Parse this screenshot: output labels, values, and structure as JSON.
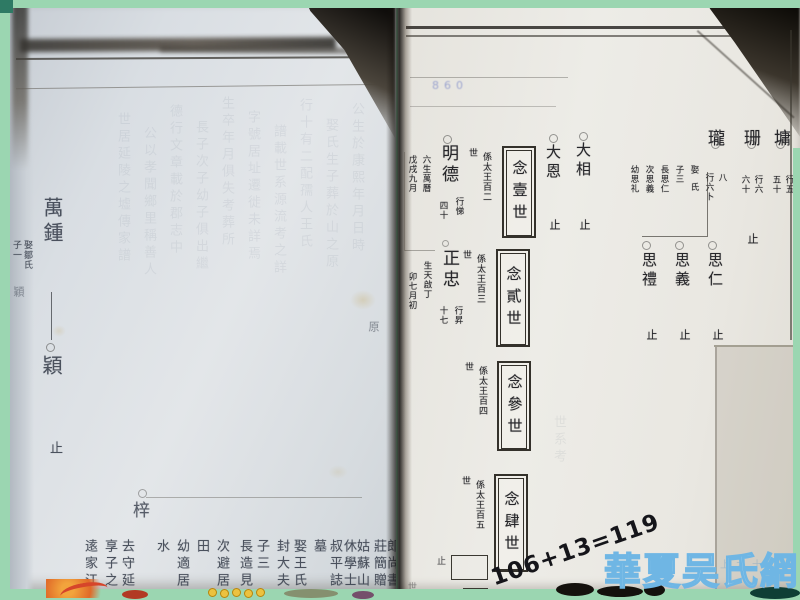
{
  "colors": {
    "mat_green": "#9bd6b1",
    "watermark_blue": "#79bfe8",
    "stamp_blue": "#6272c2",
    "ink": "#2f2d2a"
  },
  "lp": {
    "main": "萬鍾",
    "note_a": "娶鄒氏",
    "note_b": "子一",
    "note_c": "穎",
    "child": "穎",
    "stop": "止",
    "margin_char": "原",
    "zi": "梓",
    "bcols": [
      "郎尚書",
      "莊簡贈",
      "姑蘇山",
      "休學士",
      "叔平誌",
      "墓",
      "娶王氏",
      "封大夫",
      "子三",
      "長造見",
      "次避居",
      "田",
      "幼適居",
      "水"
    ],
    "blcols": [
      "去守延",
      "享子之",
      "逺家江"
    ]
  },
  "rp": {
    "stamp": "860",
    "names": [
      {
        "n": "墉",
        "a": "行五",
        "b": "五十"
      },
      {
        "n": "珊",
        "a": "行六",
        "b": "六十",
        "stop": "止"
      },
      {
        "n": "瓏",
        "a": "八",
        "b": "行六卜"
      }
    ],
    "family": [
      "娶氏",
      "子三",
      "長思仁",
      "次思義",
      "幼思礼"
    ],
    "sons": [
      {
        "n": "思仁",
        "stop": "止"
      },
      {
        "n": "思義",
        "stop": "止"
      },
      {
        "n": "思禮",
        "stop": "止"
      }
    ],
    "elders": [
      {
        "n": "大相",
        "stop": "止"
      },
      {
        "n": "大恩",
        "stop": "止"
      }
    ],
    "gens": [
      {
        "label": "念壹世",
        "note": "係太王百二",
        "cont": "世"
      },
      {
        "label": "念貳世",
        "note": "係太王百三",
        "cont": "世"
      },
      {
        "label": "念參世",
        "note": "係太王百四",
        "cont": "世"
      },
      {
        "label": "念肆世",
        "note": "係太王百五",
        "cont": "世"
      }
    ],
    "mingde": {
      "n": "明德",
      "ra": "行悌",
      "rb": "四十",
      "na": "六生萬曆",
      "nb": "戊戌九月"
    },
    "zheng": {
      "n": "正忠",
      "ra": "行昇",
      "rb": "十七",
      "na": "生天啟丁",
      "nb": "卯七月初"
    },
    "frag": {
      "stop": "止",
      "partial": "世"
    }
  },
  "ov": {
    "handwriting": "106+13=119",
    "watermark": "華夏吴氏網"
  },
  "gh": {
    "left": [
      "公生於康熙年月日時",
      "娶氏生子葬於山之原",
      "行十有二配孺人王氏",
      "譜載世系源流考之詳",
      "字號居址遷徙未詳焉",
      "生卒年月俱失考葬所",
      "長子次子幼子俱出繼",
      "德行文章載於郡志中",
      "公以孝聞鄉里稱善人",
      "世居延陵之墟傳家譜"
    ],
    "right": [
      "世系考",
      "上九十"
    ]
  }
}
